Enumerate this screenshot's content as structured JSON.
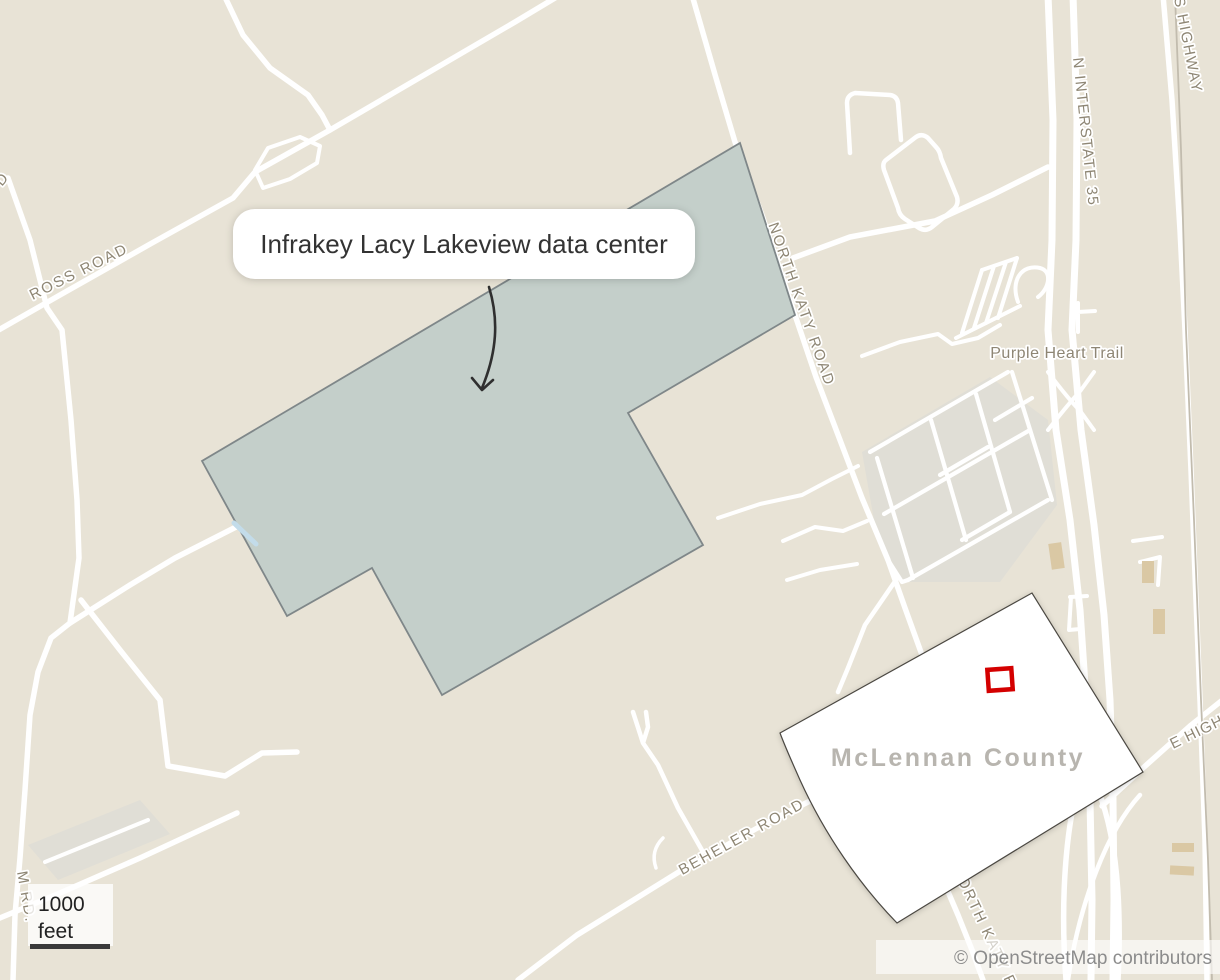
{
  "callout": {
    "text": "Infrakey Lacy Lakeview data center"
  },
  "county": {
    "name": "McLennan County"
  },
  "roads": {
    "ross": "ROSS ROAD",
    "north_katy": "NORTH KATY ROAD",
    "interstate": "N INTERSTATE 35",
    "s_highway": "S HIGHWAY",
    "purple_heart": "Purple Heart Trail",
    "beheler": "BEHELER ROAD",
    "e_highway": "E HIGHWAY",
    "m_rd": "M RD.",
    "north_katy_south": "NORTH KATY R",
    "left_fragment": "D"
  },
  "scale_bar": {
    "value": "1000",
    "unit": "feet"
  },
  "attribution": "© OpenStreetMap contributors",
  "colors": {
    "land": "#e8e3d6",
    "road": "#ffffff",
    "residential": "#e0ded6",
    "site_fill": "#c4cfca",
    "site_border": "#7f8789",
    "county_fill": "#ffffff",
    "county_border": "#4b4842",
    "marker": "#d40000",
    "label": "#8e8674",
    "county_text": "#b8b5af",
    "callout_text": "#333333",
    "attribution_text": "#8c8c8c",
    "railway": "#c2bcae",
    "building": "#dac8a4",
    "stream": "#c3dcea",
    "scale_text": "#222222",
    "scale_bar": "#3a3a3a",
    "arrow": "#2f2f2f"
  }
}
